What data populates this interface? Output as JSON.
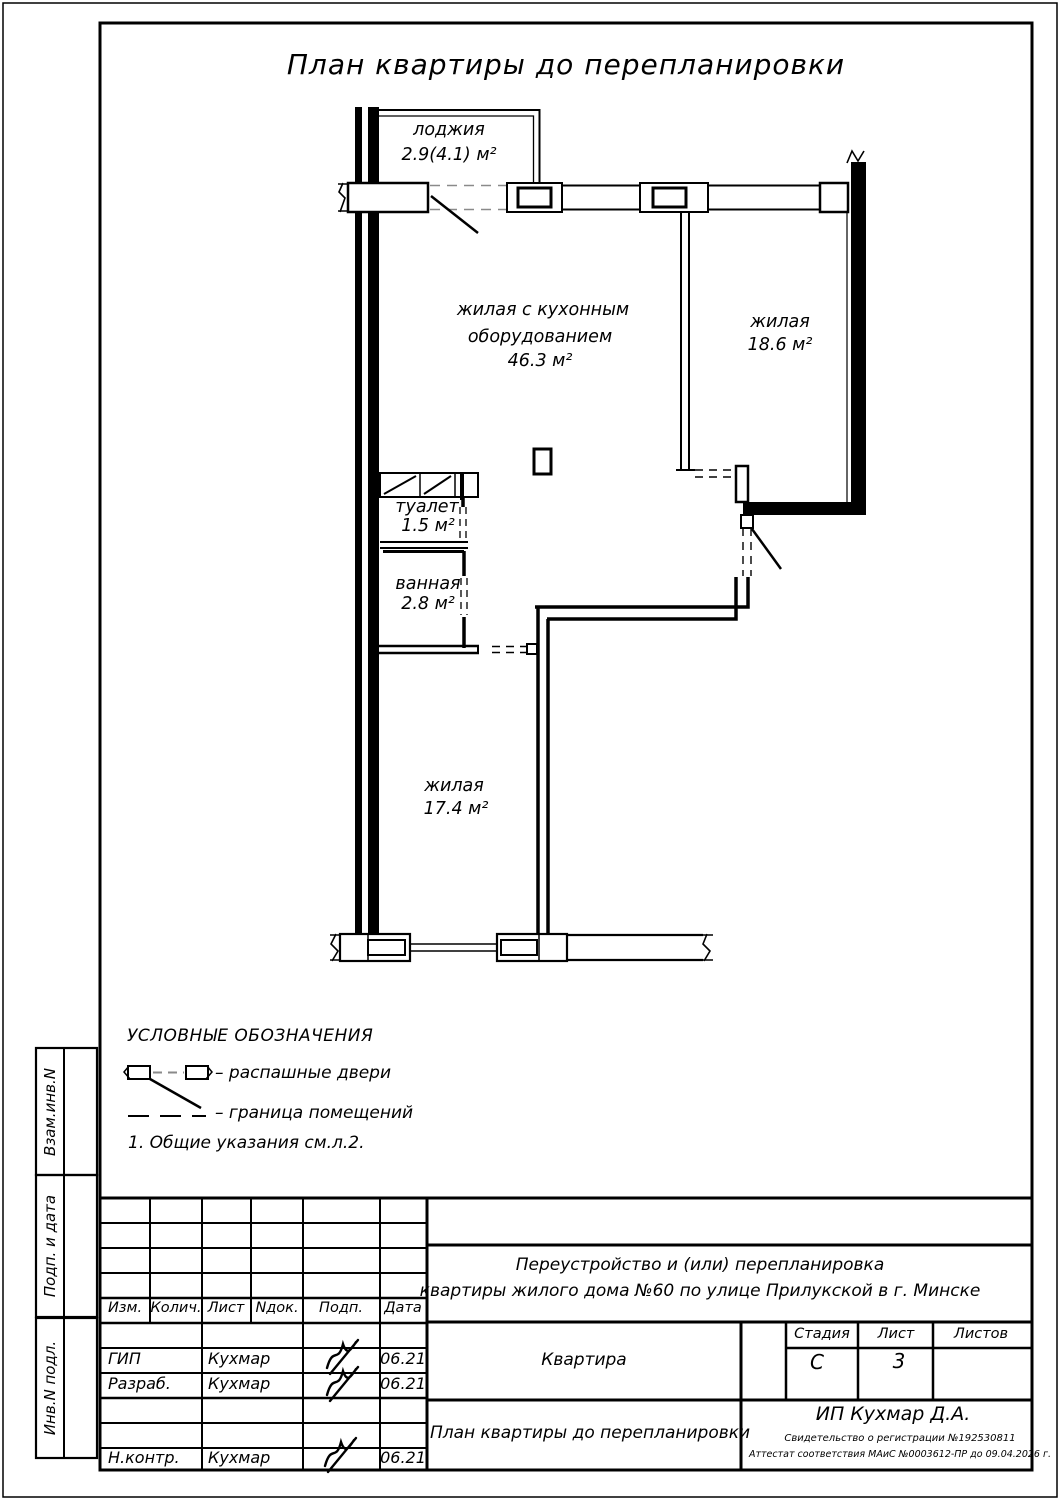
{
  "title": "План квартиры до перепланировки",
  "plan": {
    "rooms": [
      {
        "id": "loggia",
        "name": "лоджия",
        "area": "2.9(4.1) м²"
      },
      {
        "id": "living-kitchen",
        "name_lines": [
          "жилая с кухонным",
          "оборудованием"
        ],
        "area": "46.3 м²"
      },
      {
        "id": "living-right",
        "name": "жилая",
        "area": "18.6 м²"
      },
      {
        "id": "toilet",
        "name": "туалет",
        "area": "1.5 м²"
      },
      {
        "id": "bath",
        "name": "ванная",
        "area": "2.8 м²"
      },
      {
        "id": "living-bottom",
        "name": "жилая",
        "area": "17.4 м²"
      }
    ]
  },
  "legend": {
    "heading": "УСЛОВНЫЕ ОБОЗНАЧЕНИЯ",
    "items": [
      {
        "symbol": "swing-doors-symbol",
        "label": "– распашные двери"
      },
      {
        "symbol": "room-boundary-symbol",
        "label": "– граница помещений"
      }
    ],
    "note": "1. Общие указания см.л.2."
  },
  "titleblock": {
    "columns": [
      "Изм.",
      "Колич.",
      "Лист",
      "Nдок.",
      "Подп.",
      "Дата"
    ],
    "rows": [
      {
        "role": "ГИП",
        "name": "Кухмар",
        "date": "06.21"
      },
      {
        "role": "Разраб.",
        "name": "Кухмар",
        "date": "06.21"
      },
      {
        "role": "Н.контр.",
        "name": "Кухмар",
        "date": "06.21"
      }
    ],
    "project_line1": "Переустройство и (или) перепланировка",
    "project_line2": "квартиры жилого дома №60 по улице Прилукской в г. Минске",
    "object_name": "Квартира",
    "stage_label": "Стадия",
    "sheet_label": "Лист",
    "sheets_label": "Листов",
    "stage_value": "С",
    "sheet_value": "3",
    "sheets_value": "",
    "drawing_name": "План квартиры до перепланировки",
    "company": "ИП Кухмар Д.А.",
    "certificate1": "Свидетельство о регистрации №192530811",
    "certificate2": "Аттестат соответствия МАиС №0003612-ПР до 09.04.2026 г."
  },
  "sidebar": {
    "labels": [
      "Взам.инв.N",
      "Подп. и дата",
      "Инв.N подл."
    ]
  },
  "colors": {
    "line": "#000000",
    "boundary_dash": "#8a8a8a",
    "paper": "#ffffff"
  }
}
